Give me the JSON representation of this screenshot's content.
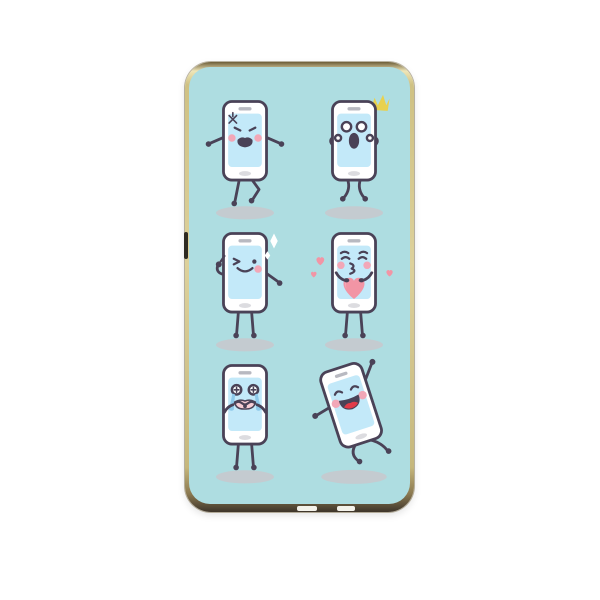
{
  "subject": "phone-case product photo with cartoon smartphone characters print",
  "colors": {
    "page_bg": "#ffffff",
    "print_bg": "#aedde1",
    "outline": "#4a4257",
    "phone_body": "#ffffff",
    "screen": "#c3e9f9",
    "speaker": "#b8b9c1",
    "home_button": "#dcdce0",
    "cheek": "#f2a7b7",
    "shadow": "#c8c8cc",
    "sparkle_yellow": "#e8d14e",
    "sparkle_white": "#ffffff",
    "heart": "#f295a5",
    "heart_light": "#f7bac6",
    "tear": "#8ec9ea",
    "mouth_pink": "#f6ccd4",
    "tongue": "#e13b49",
    "case_gold": "#cfc183",
    "case_gold_dark": "#6d5d38"
  },
  "stickers": [
    {
      "name": "angry-phone-icon",
      "emotion": "angry",
      "row": 1,
      "col": 1
    },
    {
      "name": "surprised-phone-icon",
      "emotion": "surprised",
      "row": 1,
      "col": 2
    },
    {
      "name": "winking-phone-icon",
      "emotion": "winking",
      "row": 2,
      "col": 1
    },
    {
      "name": "kissing-phone-icon",
      "emotion": "kissing-with-heart",
      "row": 2,
      "col": 2
    },
    {
      "name": "crying-phone-icon",
      "emotion": "crying",
      "row": 3,
      "col": 1
    },
    {
      "name": "dancing-phone-icon",
      "emotion": "happy-dancing",
      "row": 3,
      "col": 2
    }
  ],
  "case_features": {
    "side_button": "left-edge-button-cutout",
    "bottom": "port-and-speaker-cutouts"
  }
}
